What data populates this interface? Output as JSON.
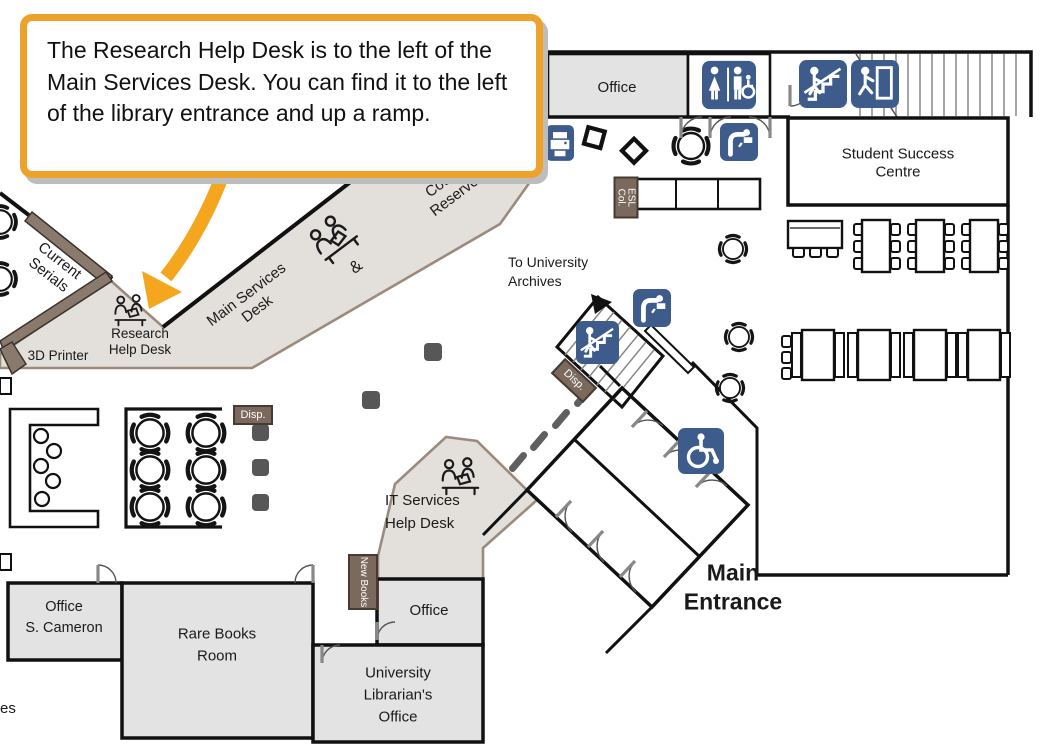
{
  "callout": {
    "text": "The Research Help Desk is to the left of the Main Services Desk. You can find it to the left of the library entrance and up a ramp."
  },
  "map": {
    "labels": {
      "office_top": "Office",
      "student_success_centre": "Student Success\nCentre",
      "to_university_archives": "To University\nArchives",
      "current_serials": "Current\nSerials",
      "printer_3d": "3D Printer",
      "research_help_desk": "Research\nHelp Desk",
      "main_services_desk": "Main Services\nDesk",
      "ampersand": "&",
      "course_reserves": "Course\nReserves",
      "it_services": "IT Services\nHelp Desk",
      "main_entrance": "Main\nEntrance",
      "office_s_cameron": "Office\nS. Cameron",
      "rare_books_room": "Rare Books\nRoom",
      "university_librarians_office": "University\nLibrarian's\nOffice",
      "office_mid": "Office",
      "esl_col": "ESL Col.",
      "new_books": "New\nBooks",
      "disp_stairs": "Disp.",
      "disp_tables": "Disp.",
      "partial_left": "es"
    },
    "icons": {
      "washroom": "accessible-washroom-icon",
      "stairs_top": "stairs-icon",
      "exit_top": "emergency-exit-icon",
      "stairs_mid": "stairs-icon",
      "fountain_top": "drinking-fountain-icon",
      "fountain_mid": "drinking-fountain-icon",
      "printer": "print-station-icon",
      "wheelchair": "wheelchair-accessible-icon",
      "helpdesk": "help-desk-people-icon"
    },
    "colors": {
      "accent_orange": "#EDA22A",
      "arrow_orange": "#F4A61E",
      "icon_blue": "#3D5C8C",
      "room_gray": "#E3E3E3",
      "desk_beige": "#E3DFDA",
      "tag_brown": "#7A695C",
      "wall_black": "#111111"
    }
  }
}
